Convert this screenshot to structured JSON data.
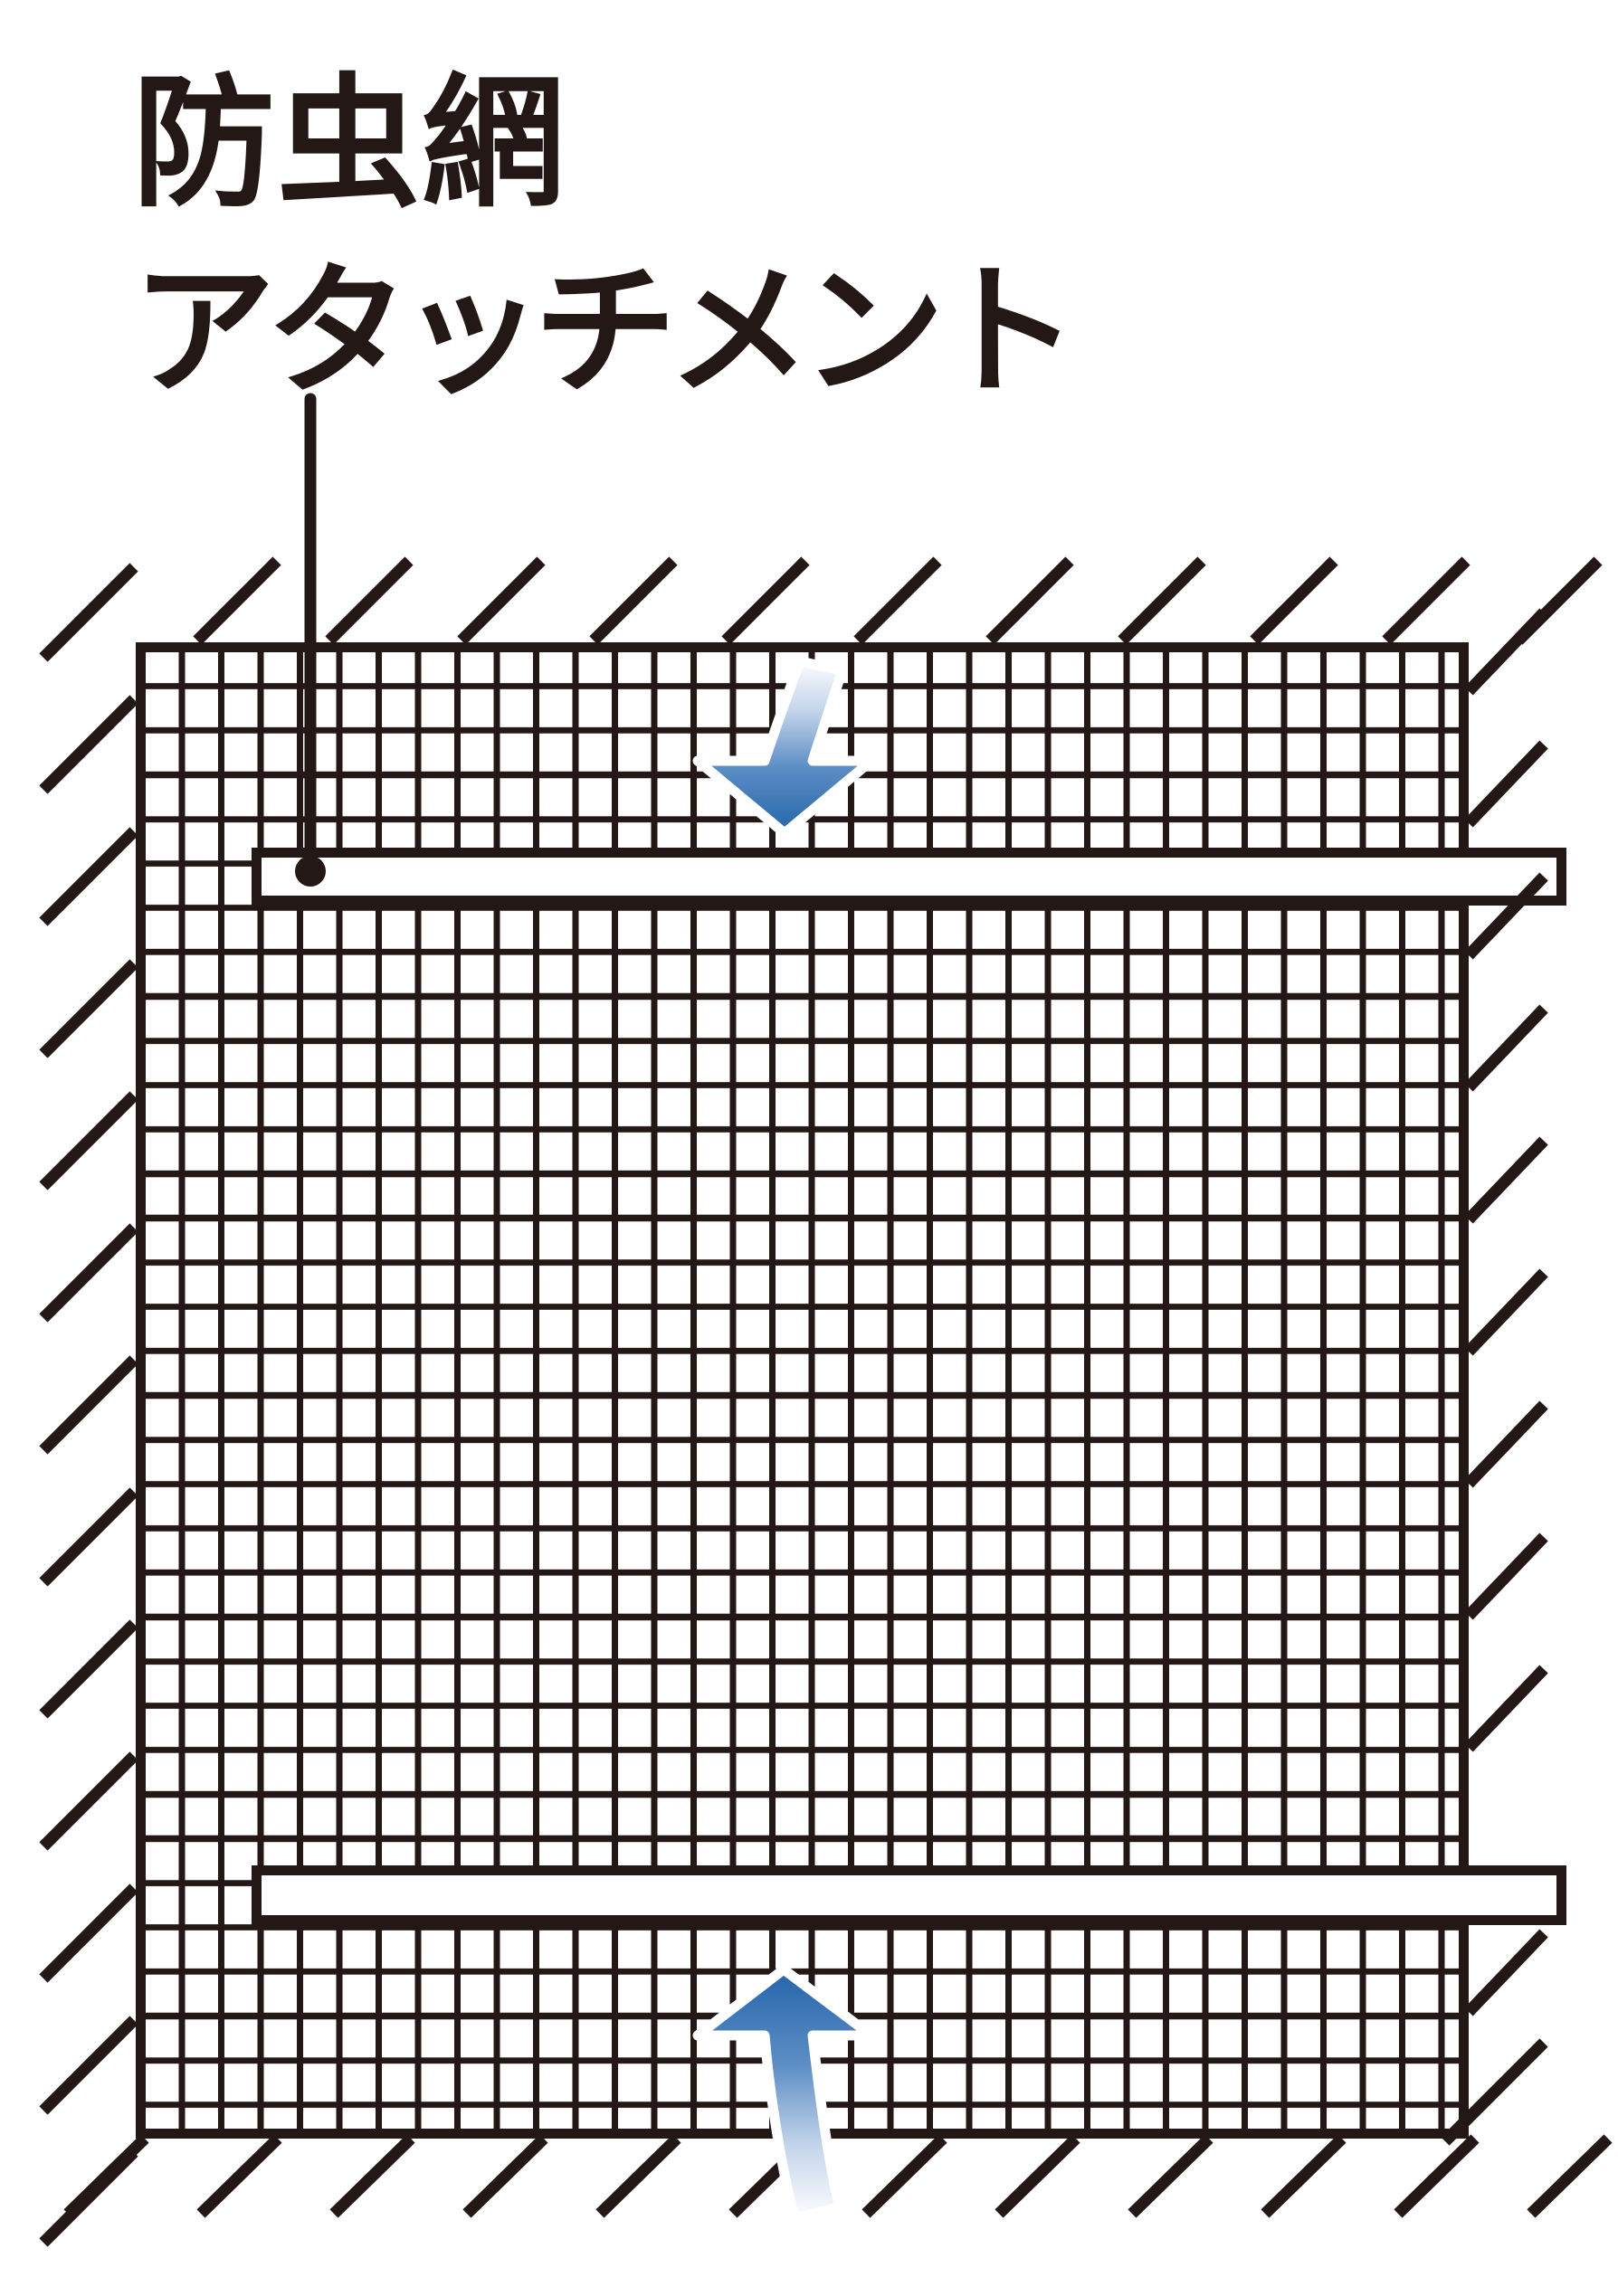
{
  "title": {
    "line1": "防虫網",
    "line2": "アタッチメント"
  },
  "icons": {
    "top_arrow": "arrow-down-icon",
    "bottom_arrow": "arrow-up-icon",
    "callout_marker": "leader-dot-icon"
  },
  "colors": {
    "ink": "#231815",
    "background": "#ffffff",
    "arrow_blue_dark": "#2465aa",
    "arrow_blue_mid": "#5d8ec5",
    "arrow_blue_light": "#c3d4ea",
    "arrow_outline": "#ffffff"
  }
}
